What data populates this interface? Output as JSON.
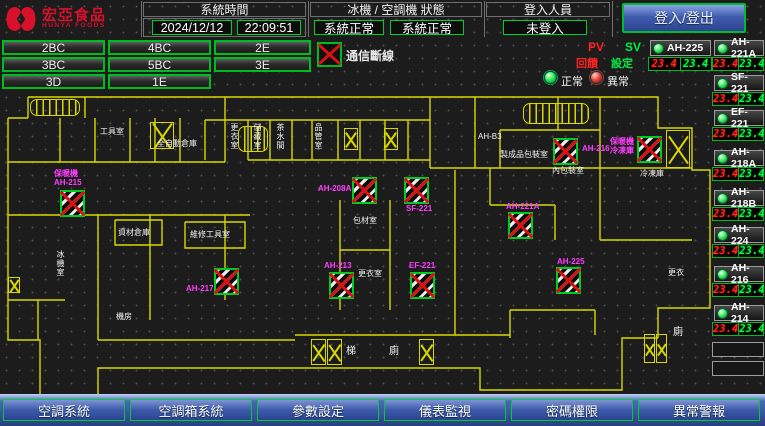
{
  "header": {
    "brand": "宏亞食品",
    "brand_en": "HUNYA FOODS",
    "system_time_label": "系統時間",
    "date": "2024/12/12",
    "time": "22:09:51",
    "machine_status_label": "冰機 / 空調機 狀態",
    "chiller_status": "系統正常",
    "ahu_status": "系統正常",
    "login_label": "登入人員",
    "login_status": "未登入",
    "login_button_label": "登入/登出"
  },
  "zone_buttons": [
    "2BC",
    "4BC",
    "2E",
    "3BC",
    "5BC",
    "3E",
    "3D",
    "1E"
  ],
  "legend": {
    "comm_error_label": "通信斷線",
    "pv_label": "PV",
    "sv_label": "SV",
    "feedback_label": "回饋",
    "setpoint_label": "設定",
    "normal_label": "正常",
    "abnormal_label": "異常"
  },
  "equipment": {
    "featured": {
      "name": "AH-225",
      "pv": "23.4",
      "sv": "23.4"
    },
    "units": [
      {
        "name": "AH-221A",
        "pv": "23.4",
        "sv": "23.4"
      },
      {
        "name": "SF-221",
        "pv": "23.4",
        "sv": "23.4"
      },
      {
        "name": "EF-221",
        "pv": "23.4",
        "sv": "23.4"
      },
      {
        "name": "AH-218A",
        "pv": "23.4",
        "sv": "23.4"
      },
      {
        "name": "AH-218B",
        "pv": "23.4",
        "sv": "23.4"
      },
      {
        "name": "AH-224",
        "pv": "23.4",
        "sv": "23.4"
      },
      {
        "name": "AH-216",
        "pv": "23.4",
        "sv": "23.4"
      },
      {
        "name": "AH-214",
        "pv": "23.4",
        "sv": "23.4"
      }
    ]
  },
  "floor_plan": {
    "rooms": [
      {
        "text": "工具室"
      },
      {
        "text": "全自動倉庫"
      },
      {
        "text": "更衣室"
      },
      {
        "text": "儲藏室"
      },
      {
        "text": "茶水間"
      },
      {
        "text": "品管室"
      },
      {
        "text": "AH-B3"
      },
      {
        "text": "製成品包裝室"
      },
      {
        "text": "內包裝室"
      },
      {
        "text": "冷凍庫"
      },
      {
        "text": "資材倉庫"
      },
      {
        "text": "維修工具室"
      },
      {
        "text": "包材室"
      },
      {
        "text": "更衣室"
      },
      {
        "text": "冰機室"
      },
      {
        "text": "機房"
      },
      {
        "text": "梯"
      },
      {
        "text": "廁"
      },
      {
        "text": "更衣"
      },
      {
        "text": "廁"
      }
    ],
    "devices": [
      {
        "line1": "保暖機",
        "line2": "AH-215"
      },
      {
        "line1": "AH-217"
      },
      {
        "line1": "AH-208A"
      },
      {
        "line1": "SF-221"
      },
      {
        "line1": "AH-213"
      },
      {
        "line1": "EF-221"
      },
      {
        "line1": "AH-221A"
      },
      {
        "line1": "AH-216"
      },
      {
        "line1": "保暖機",
        "line2": "冷凍庫"
      },
      {
        "line1": "AH-225"
      }
    ]
  },
  "nav_buttons": [
    "空調系統",
    "空調箱系統",
    "參數設定",
    "儀表監視",
    "密碼權限",
    "異常警報"
  ],
  "colors": {
    "accent_green": "#00cc33",
    "alarm_red": "#e01010",
    "device_magenta": "#ff3cff",
    "wall_yellow": "#d8d800",
    "nav_blue": "#3a57a8",
    "brand_red": "#d8102a"
  }
}
